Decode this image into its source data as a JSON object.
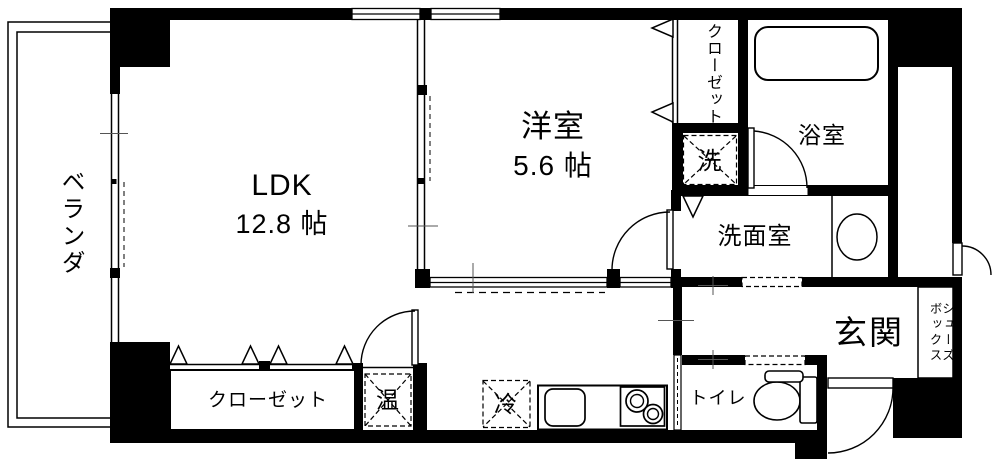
{
  "floorplan": {
    "type": "apartment-floor-plan",
    "colors": {
      "wall": "#000000",
      "floor": "#ffffff",
      "line": "#000000"
    },
    "rooms": {
      "veranda": {
        "label": "ベランダ"
      },
      "ldk": {
        "label": "LDK",
        "size": "12.8 帖"
      },
      "western_room": {
        "label": "洋室",
        "size": "5.6 帖"
      },
      "closet_upper": {
        "label": "クローゼット"
      },
      "bathroom": {
        "label": "浴室"
      },
      "laundry": {
        "label": "洗"
      },
      "washroom": {
        "label": "洗面室"
      },
      "closet_lower": {
        "label": "クローゼット"
      },
      "water_heater": {
        "label": "温"
      },
      "refrigerator": {
        "label": "冷"
      },
      "toilet": {
        "label": "トイレ"
      },
      "entrance": {
        "label": "玄関"
      },
      "shoe_box": {
        "label": "シューズボックス"
      }
    }
  }
}
